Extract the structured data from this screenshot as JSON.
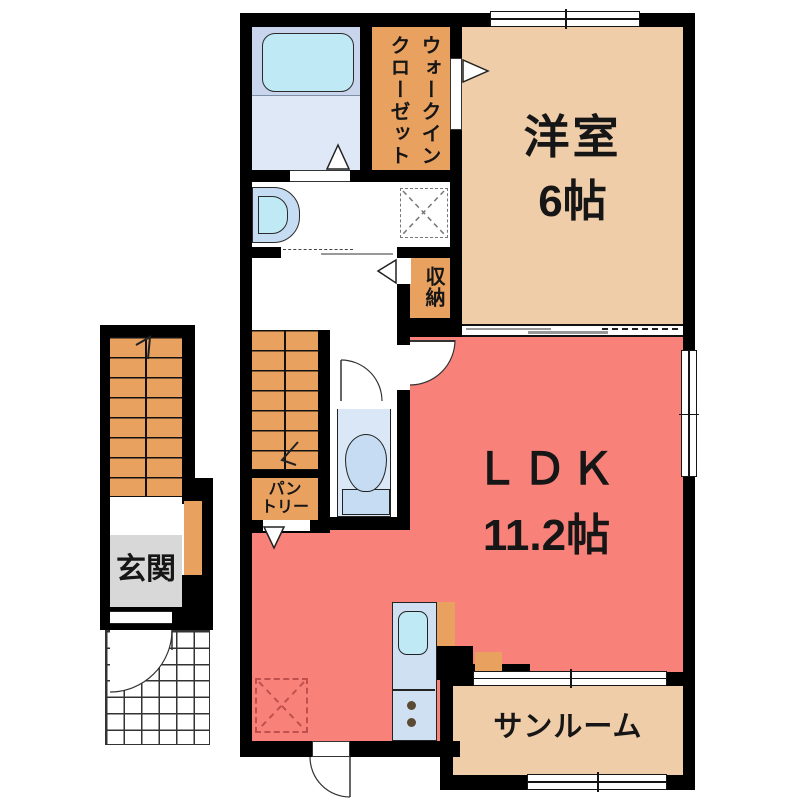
{
  "floorplan": {
    "type": "apartment-floor-plan",
    "rooms": {
      "western_room": {
        "name": "洋室",
        "area": "6帖"
      },
      "ldk": {
        "name": "ＬＤＫ",
        "area": "11.2帖"
      },
      "sunroom": {
        "name": "サンルーム"
      },
      "entrance": {
        "name": "玄関"
      },
      "walk_in_closet": {
        "name": "ウォークインクローゼット"
      },
      "storage": {
        "name": "収納"
      },
      "pantry": {
        "line1": "パン",
        "line2": "トリー"
      }
    },
    "colors": {
      "wall": "#000000",
      "ldk_pink": "#f8827a",
      "tatami_tan": "#f0cda9",
      "closet_orange": "#e9a160",
      "entrance_gray": "#d8d8d8",
      "bath_floor_upper": "#c9d5ed",
      "bath_floor_lower": "#dee8f6",
      "fixture_blue": "#c6dcf2",
      "water_cyan": "#bfeaf5",
      "toilet_floor": "#d9e7f6",
      "kitchen_counter": "#cfe0f2",
      "burner_brown": "#5b4a33",
      "dashed_red": "#c0504d"
    }
  }
}
